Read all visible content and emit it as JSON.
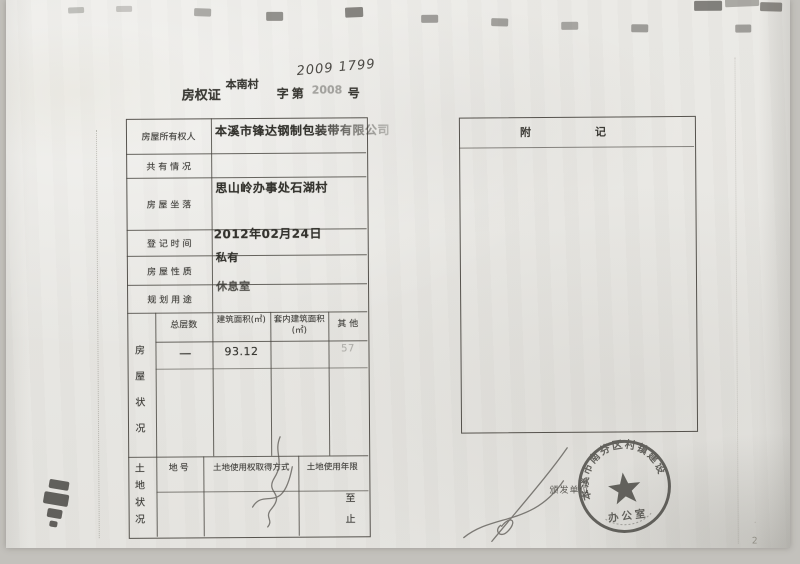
{
  "header": {
    "doc_type": "房权证",
    "region": "本南村",
    "series_label": "字第",
    "printed_no": "2008",
    "handwritten_no": "2009 1799",
    "no_suffix": "号"
  },
  "owner_table": {
    "rows": [
      {
        "label": "房屋所有权人",
        "value": "本溪市锋达钢制包装带有限公司"
      },
      {
        "label": "共 有 情 况",
        "value": ""
      },
      {
        "label": "房 屋 坐 落",
        "value": "思山岭办事处石湖村"
      },
      {
        "label": "登 记 时 间",
        "value": "2012年02月24日"
      },
      {
        "label": "房 屋 性 质",
        "value": "私有"
      },
      {
        "label": "规 划 用 途",
        "value": "休息室"
      }
    ]
  },
  "house_status": {
    "side_label": "房屋状况",
    "col_floors": "总层数",
    "col_area": "建筑面积(㎡)",
    "col_inner_area": "套内建筑面积(㎡)",
    "col_other": "其  他",
    "floors": "一",
    "area": "93.12",
    "inner_area": "",
    "other": "57"
  },
  "land_status": {
    "side_label": "土地状况",
    "col_plot_no": "地号",
    "col_acquisition": "土地使用权取得方式",
    "col_term": "土地使用年限",
    "term_from": "至",
    "term_to": "止"
  },
  "notes_box": {
    "title": "附记"
  },
  "issuer": {
    "label": "颁发单位"
  },
  "seal": {
    "arc_text": "本溪市南芬区村镇建设",
    "center_text": "办公室"
  },
  "page_number": "2"
}
